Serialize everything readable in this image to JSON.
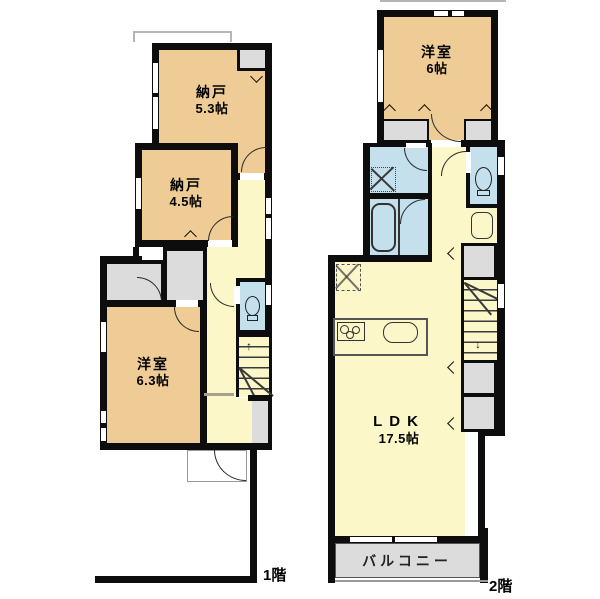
{
  "colors": {
    "room_fill": "#efcc95",
    "hall_fill": "#fbf7c9",
    "wet_area_fill": "#c4e0ec",
    "closet_fill": "#dcdcdc",
    "wall": "#0d0d0d"
  },
  "icons": {
    "arrow_up": "↑",
    "arrow_down": "↓"
  },
  "floor1": {
    "floor_label": "1階",
    "rooms": {
      "nando1": {
        "name": "納戸",
        "size": "5.3帖"
      },
      "nando2": {
        "name": "納戸",
        "size": "4.5帖"
      },
      "yoshitsu": {
        "name": "洋室",
        "size": "6.3帖"
      }
    }
  },
  "floor2": {
    "floor_label": "2階",
    "rooms": {
      "yoshitsu": {
        "name": "洋室",
        "size": "6帖"
      },
      "ldk": {
        "name": "LDK",
        "size": "17.5帖"
      },
      "balcony": {
        "name": "バルコニー"
      }
    }
  }
}
